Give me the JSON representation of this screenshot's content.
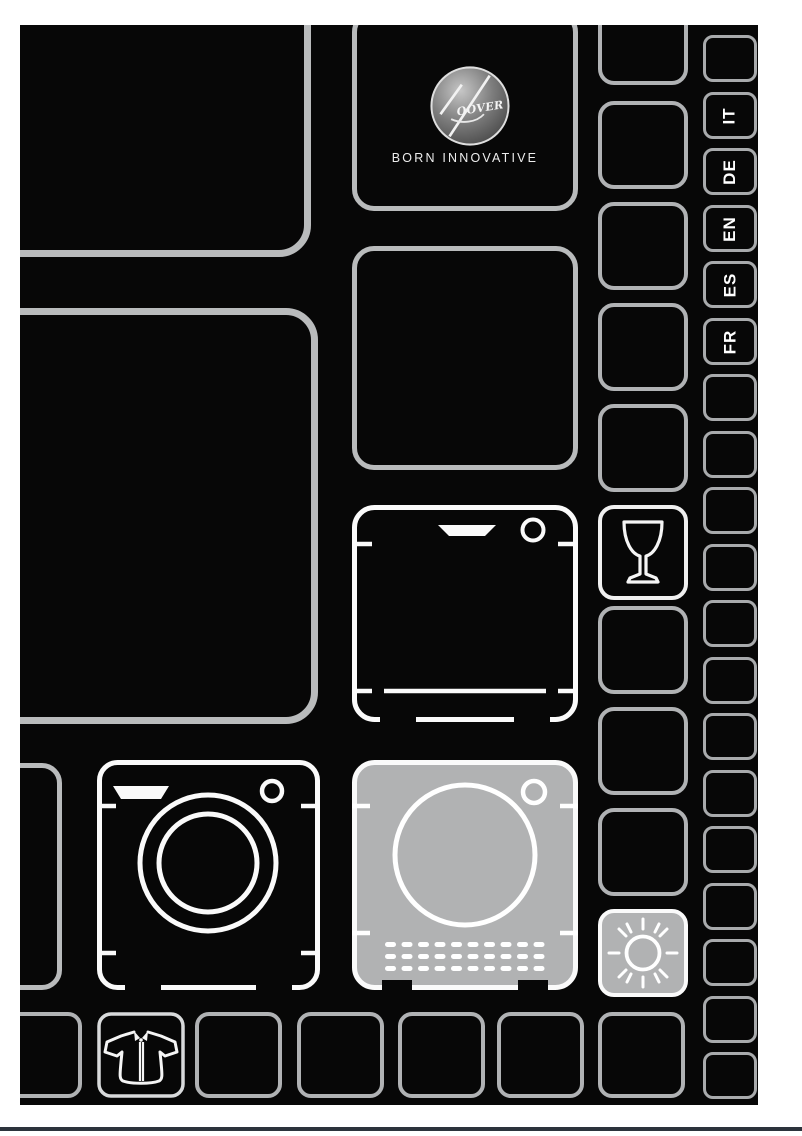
{
  "document": {
    "type": "appliance-manual-cover",
    "brand": "Hoover",
    "logo_text": "OOVER",
    "tagline": "BORN INNOVATIVE",
    "languages": [
      "IT",
      "DE",
      "EN",
      "ES",
      "FR"
    ],
    "icon_cells": [
      "hoover-logo",
      "dishwasher-icon",
      "washing-machine-icon",
      "tumble-dryer-icon",
      "wine-glass-icon",
      "sun-icon",
      "shirt-icon"
    ],
    "colors": {
      "page_bg": "#ffffff",
      "content_bg": "#070707",
      "outline_gray": "#b9bbbc",
      "outline_white": "#fafafa",
      "fill_gray": "#b1b2b3",
      "bottom_rule": "#2c333c"
    }
  }
}
